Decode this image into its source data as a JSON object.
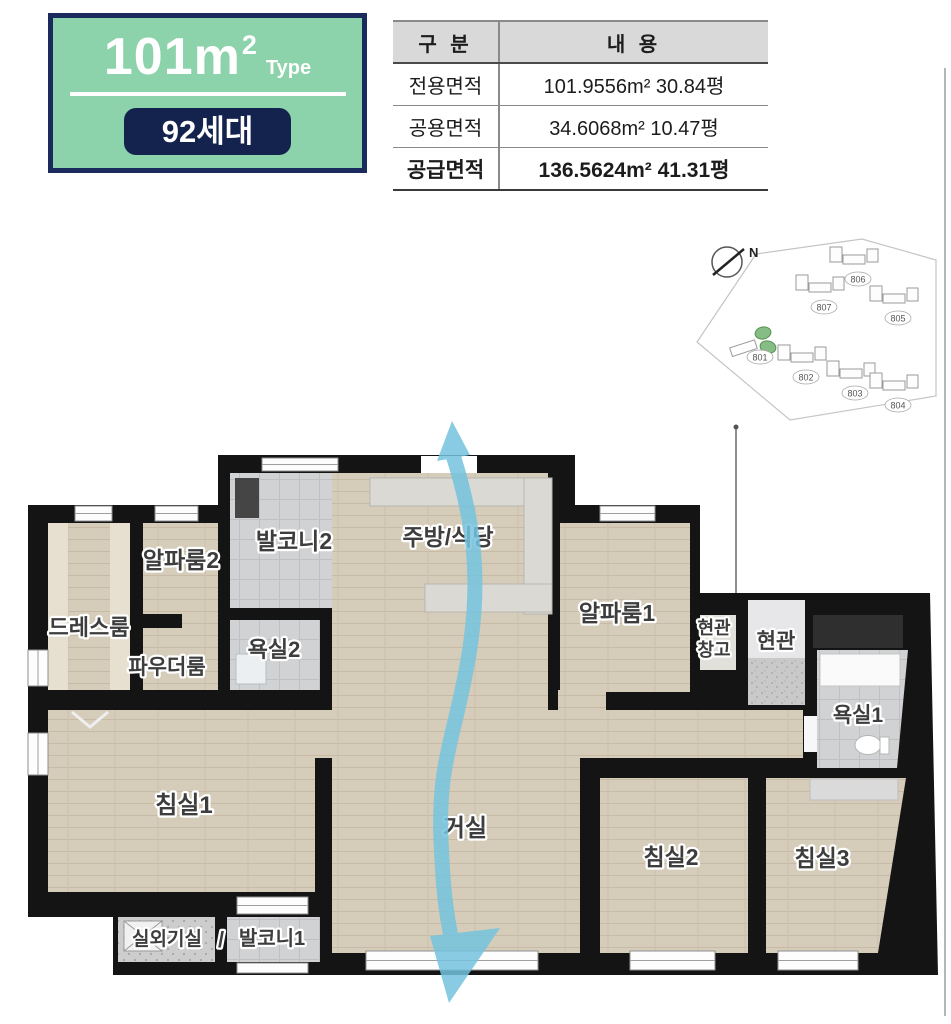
{
  "header": {
    "type_box": {
      "area_main": "101m",
      "area_sup": "2",
      "type_label": "Type",
      "badge": "92세대",
      "bg_color": "#8cd2aa",
      "border_color": "#1b2a5c",
      "badge_color": "#14234e"
    },
    "table": {
      "col_headers": [
        "구 분",
        "내 용"
      ],
      "rows": [
        {
          "label": "전용면적",
          "value": "101.9556m² 30.84평"
        },
        {
          "label": "공용면적",
          "value": "34.6068m² 10.47평"
        },
        {
          "label": "공급면적",
          "value": "136.5624m² 41.31평"
        }
      ]
    }
  },
  "site_plan": {
    "compass_label": "N",
    "highlight_color": "#85bd85",
    "buildings": [
      {
        "id": "807"
      },
      {
        "id": "806"
      },
      {
        "id": "805"
      },
      {
        "id": "801",
        "highlighted": true
      },
      {
        "id": "802"
      },
      {
        "id": "803"
      },
      {
        "id": "804"
      }
    ]
  },
  "floor_plan": {
    "arrow_color": "#74c3de",
    "divider_slash": "/",
    "rooms": [
      {
        "label": "드레스룸"
      },
      {
        "label": "알파룸2"
      },
      {
        "label": "발코니2"
      },
      {
        "label": "주방/식당"
      },
      {
        "label": "알파룸1"
      },
      {
        "label": "현관창고",
        "line1": "현관",
        "line2": "창고"
      },
      {
        "label": "현관"
      },
      {
        "label": "욕실2"
      },
      {
        "label": "파우더룸"
      },
      {
        "label": "욕실1"
      },
      {
        "label": "침실1"
      },
      {
        "label": "거실"
      },
      {
        "label": "침실2"
      },
      {
        "label": "침실3"
      },
      {
        "label": "실외기실"
      },
      {
        "label": "발코니1"
      }
    ]
  }
}
